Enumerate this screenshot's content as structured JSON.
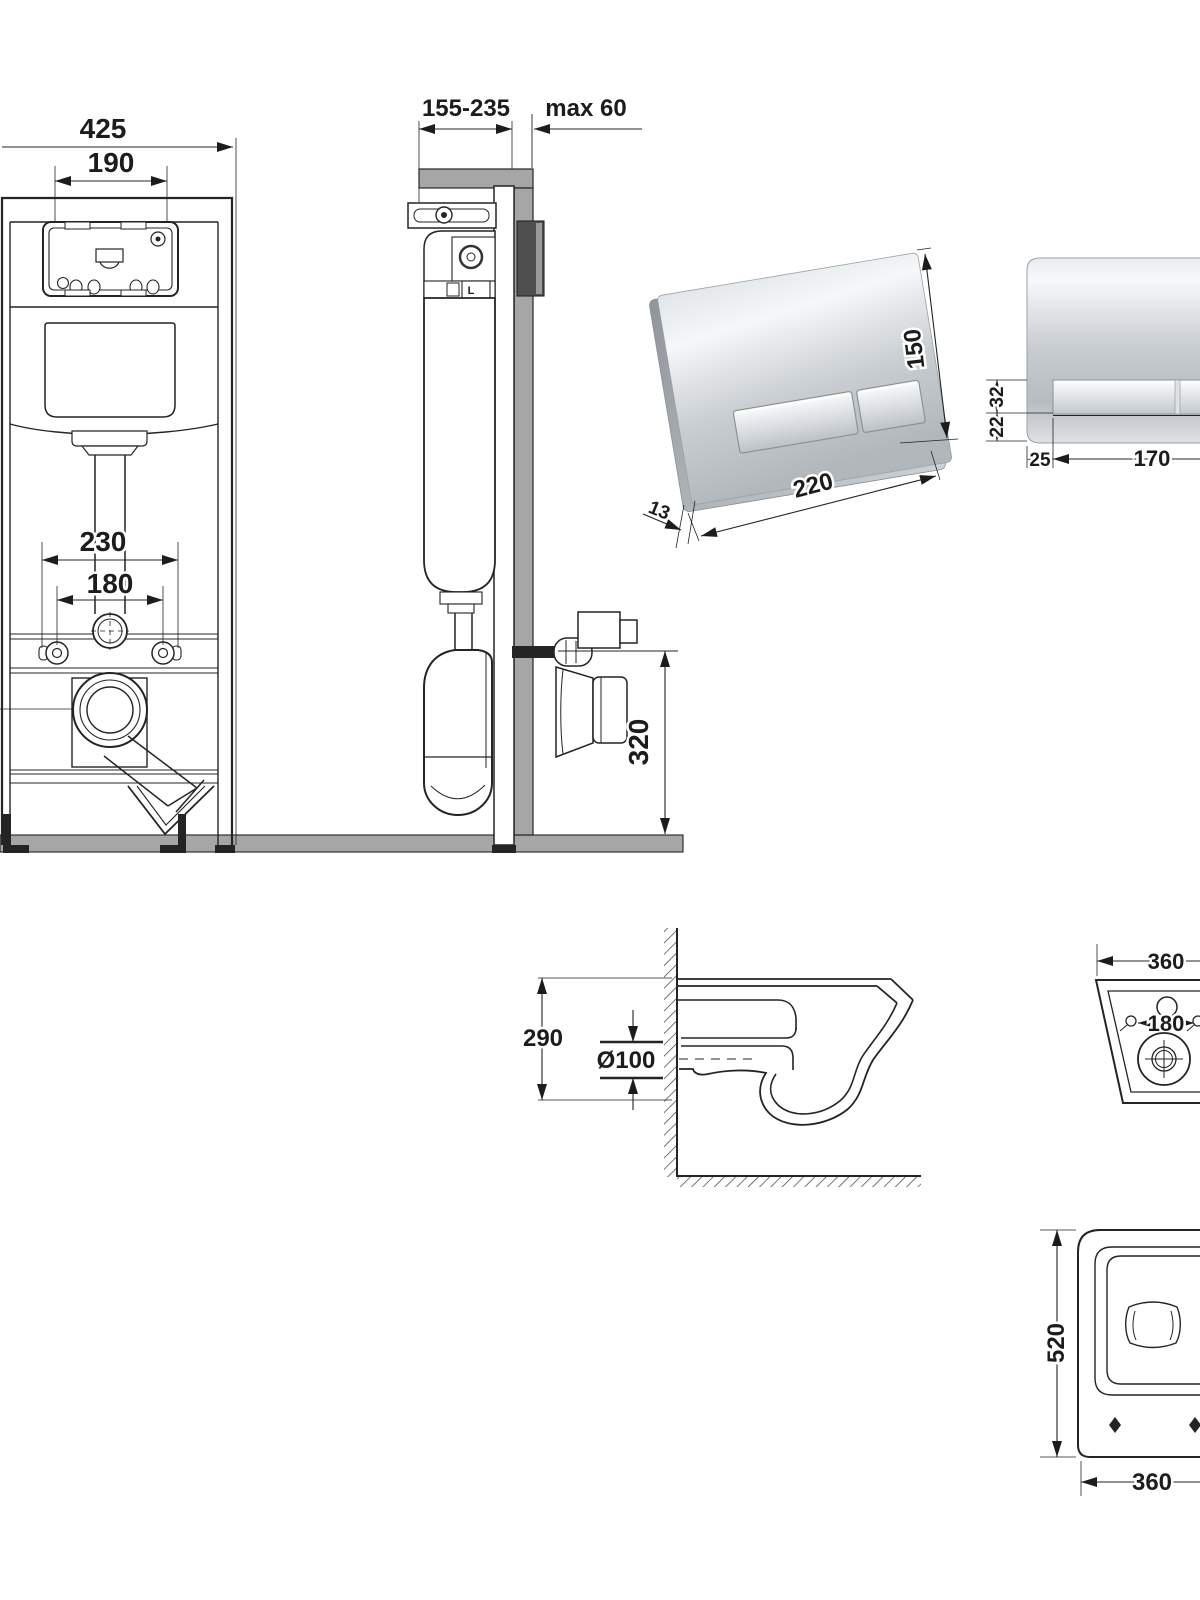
{
  "frame_front": {
    "width": "425",
    "opening": "190",
    "spacing_outer": "230",
    "spacing_inner": "180"
  },
  "frame_side": {
    "depth_range": "155-235",
    "max_wall": "max 60",
    "outlet_height": "320",
    "valve": "L"
  },
  "plate3d": {
    "width": "220",
    "height": "150",
    "thickness": "13"
  },
  "plate_front": {
    "button_h": "32",
    "below_gap": "22",
    "margin": "25",
    "buttons_w": "170"
  },
  "wc_side": {
    "height": "290",
    "drain": "Ø100"
  },
  "wc_rear": {
    "width": "360",
    "holes": "180"
  },
  "wc_bottom": {
    "depth": "520",
    "width": "360"
  },
  "colors": {
    "line": "#242424",
    "wall_gray": "#a6a6a6",
    "chrome_light": "#f4f6f7",
    "chrome_dark": "#b4b9be"
  }
}
